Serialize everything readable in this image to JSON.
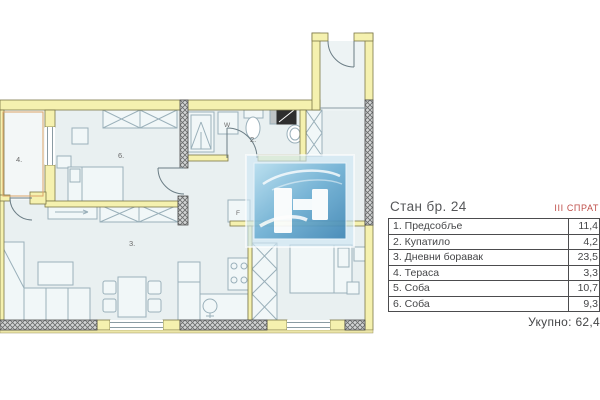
{
  "panel": {
    "title": "Стан бр. 24",
    "floor": "III СПРАТ",
    "rows": [
      {
        "label": "1. Предсобље",
        "value": "11,4"
      },
      {
        "label": "2. Купатило",
        "value": "4,2"
      },
      {
        "label": "3. Дневни боравак",
        "value": "23,5"
      },
      {
        "label": "4. Тераса",
        "value": "3,3"
      },
      {
        "label": "5. Соба",
        "value": "10,7"
      },
      {
        "label": "6. Соба",
        "value": "9,3"
      }
    ],
    "total_label": "Укупно:",
    "total_value": "62,4"
  },
  "plan": {
    "labels": {
      "terrace": "4.",
      "bedroom6": "6.",
      "living": "3.",
      "bathroom": "2.",
      "washer": "W",
      "fridge": "F"
    }
  },
  "colors": {
    "wall_yellow": "#f5f1af",
    "wall_outline": "#7c7747",
    "hatch_fill": "#d2d4d4",
    "room_fill": "#e9f0f1",
    "furniture_line": "#9ab0ba",
    "accent_red": "#bf4f4a",
    "text_dark": "#58595b",
    "logo_blue_light": "#b8dff0",
    "logo_blue_dark": "#3f86b5"
  }
}
